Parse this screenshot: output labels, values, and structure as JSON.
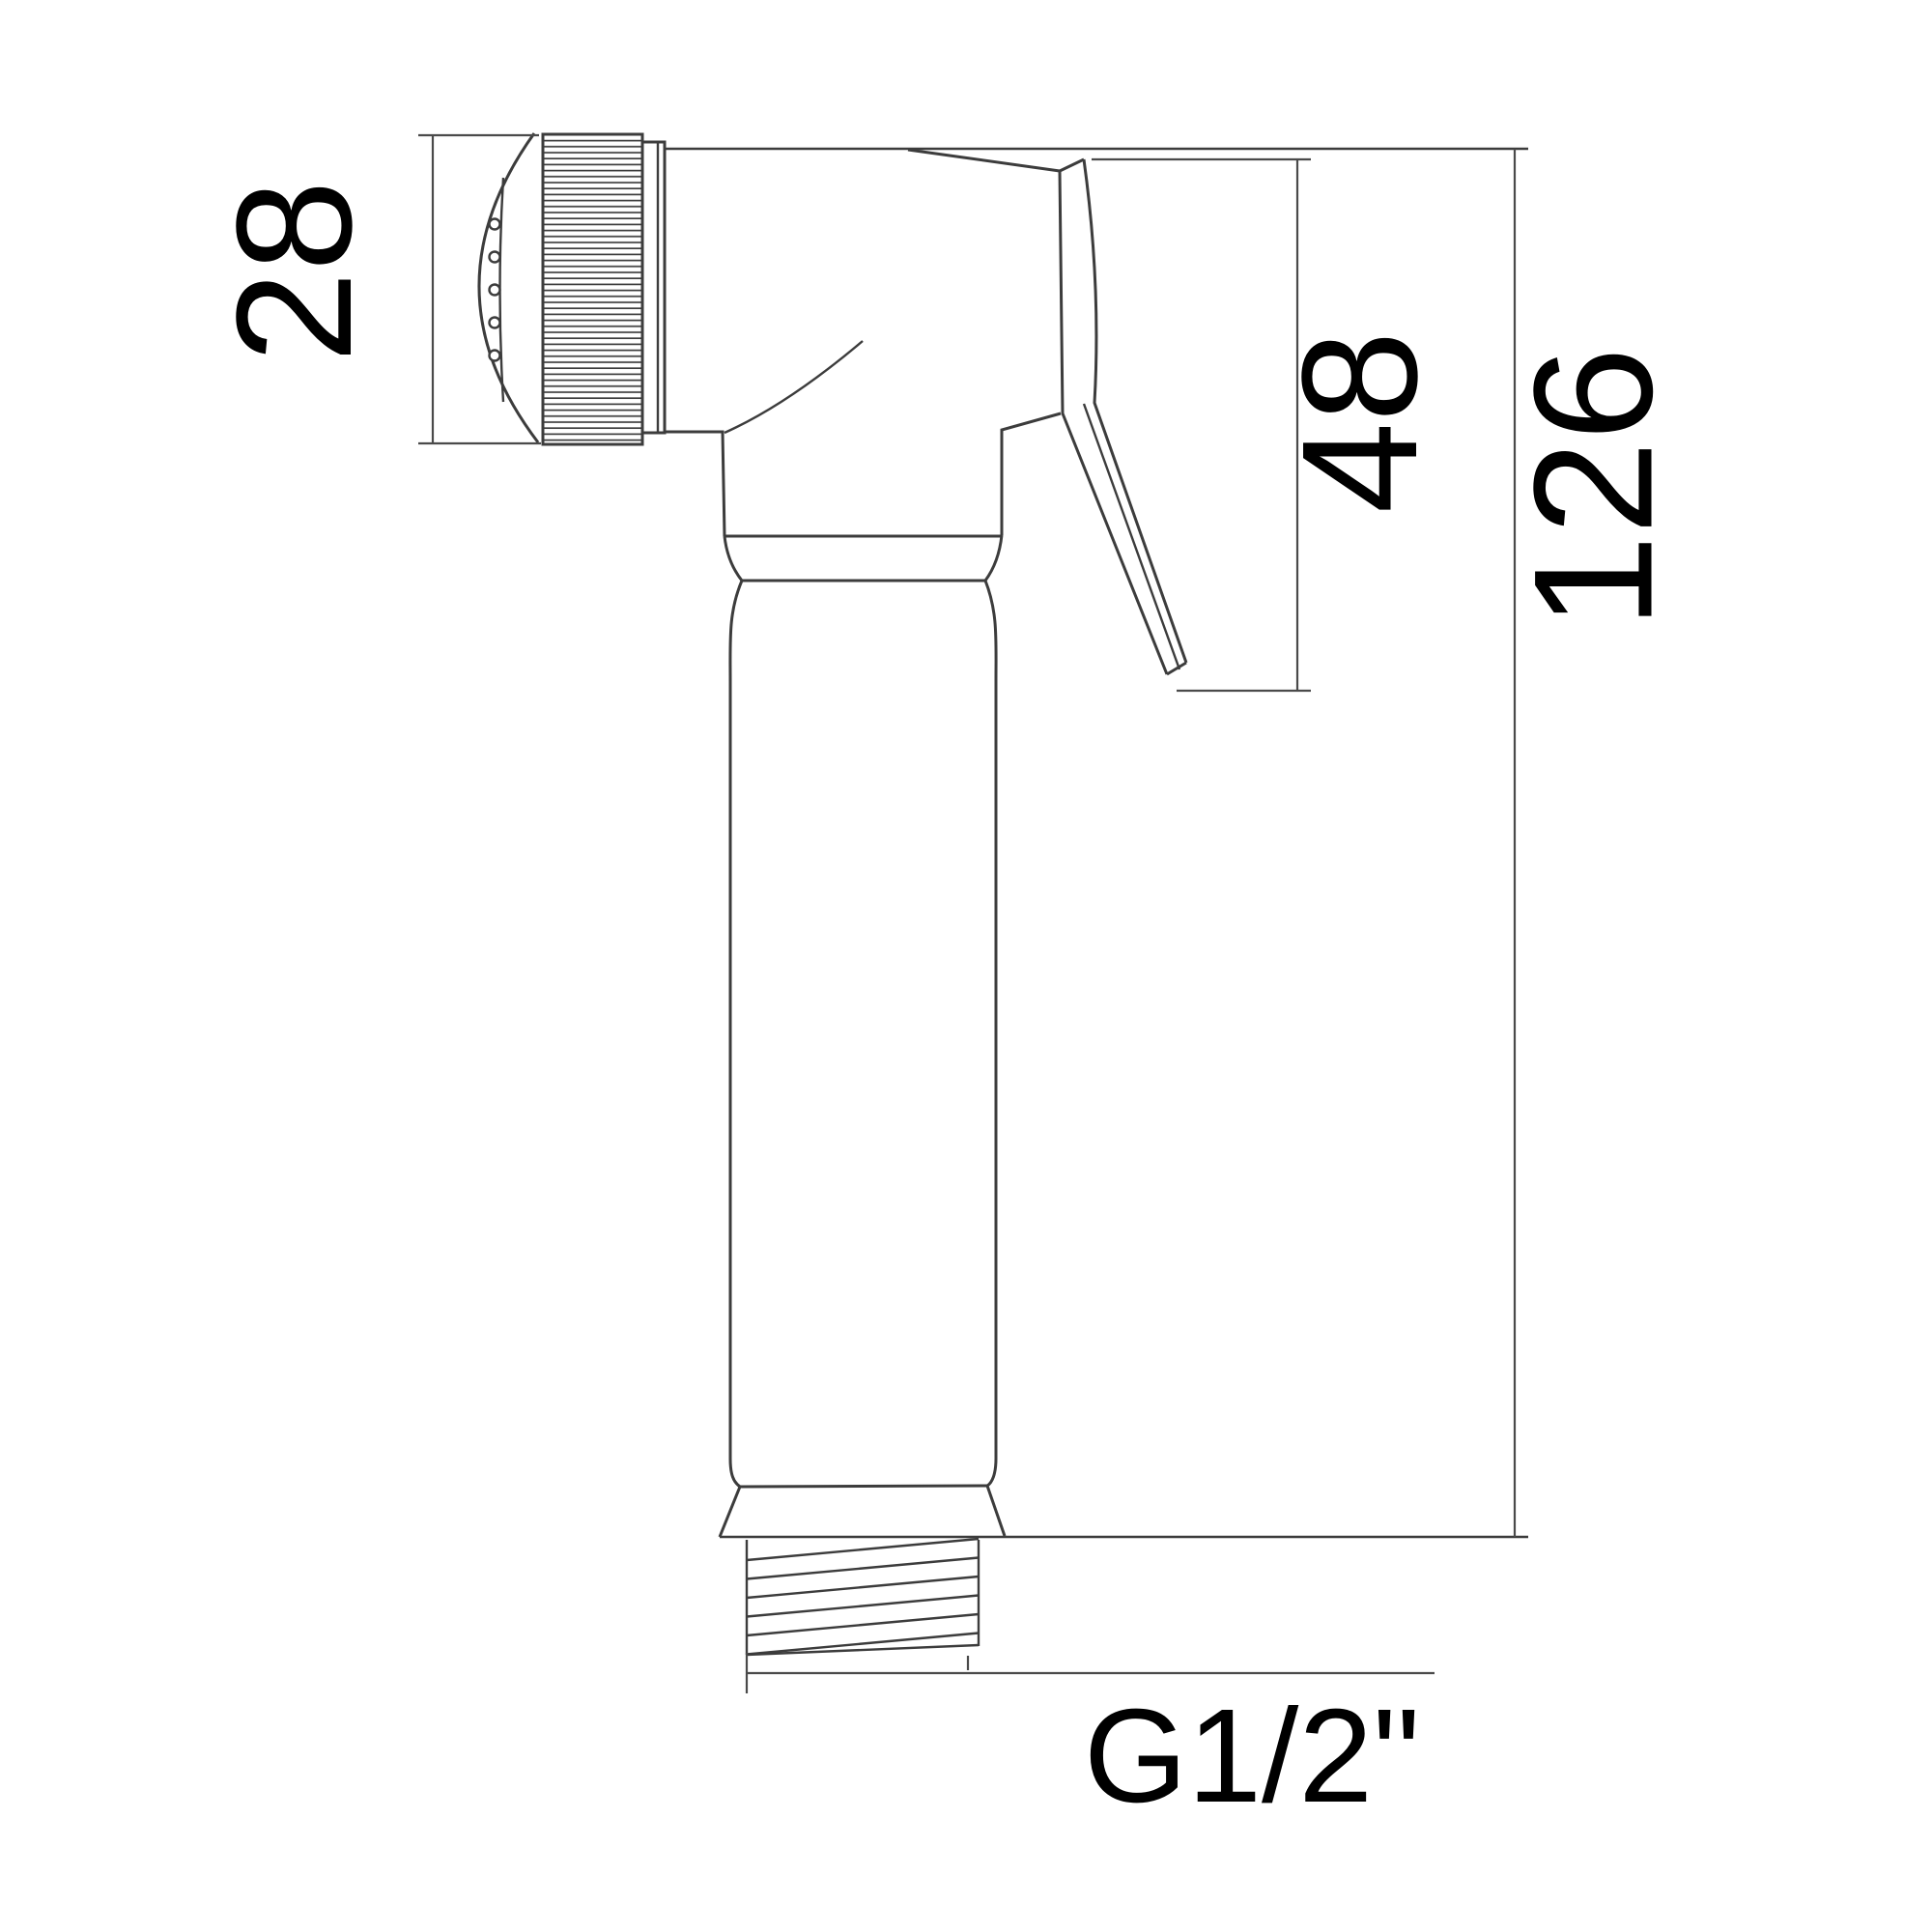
{
  "drawing": {
    "type": "technical-dimension-drawing",
    "subject": "handheld bidet sprayer side view",
    "background_color": "#ffffff",
    "line_color": "#3c3c3c",
    "text_color": "#000000",
    "dimensions": {
      "head_width": "28",
      "trigger_length": "48",
      "overall_length": "126",
      "thread_size": "G1/2\""
    }
  }
}
